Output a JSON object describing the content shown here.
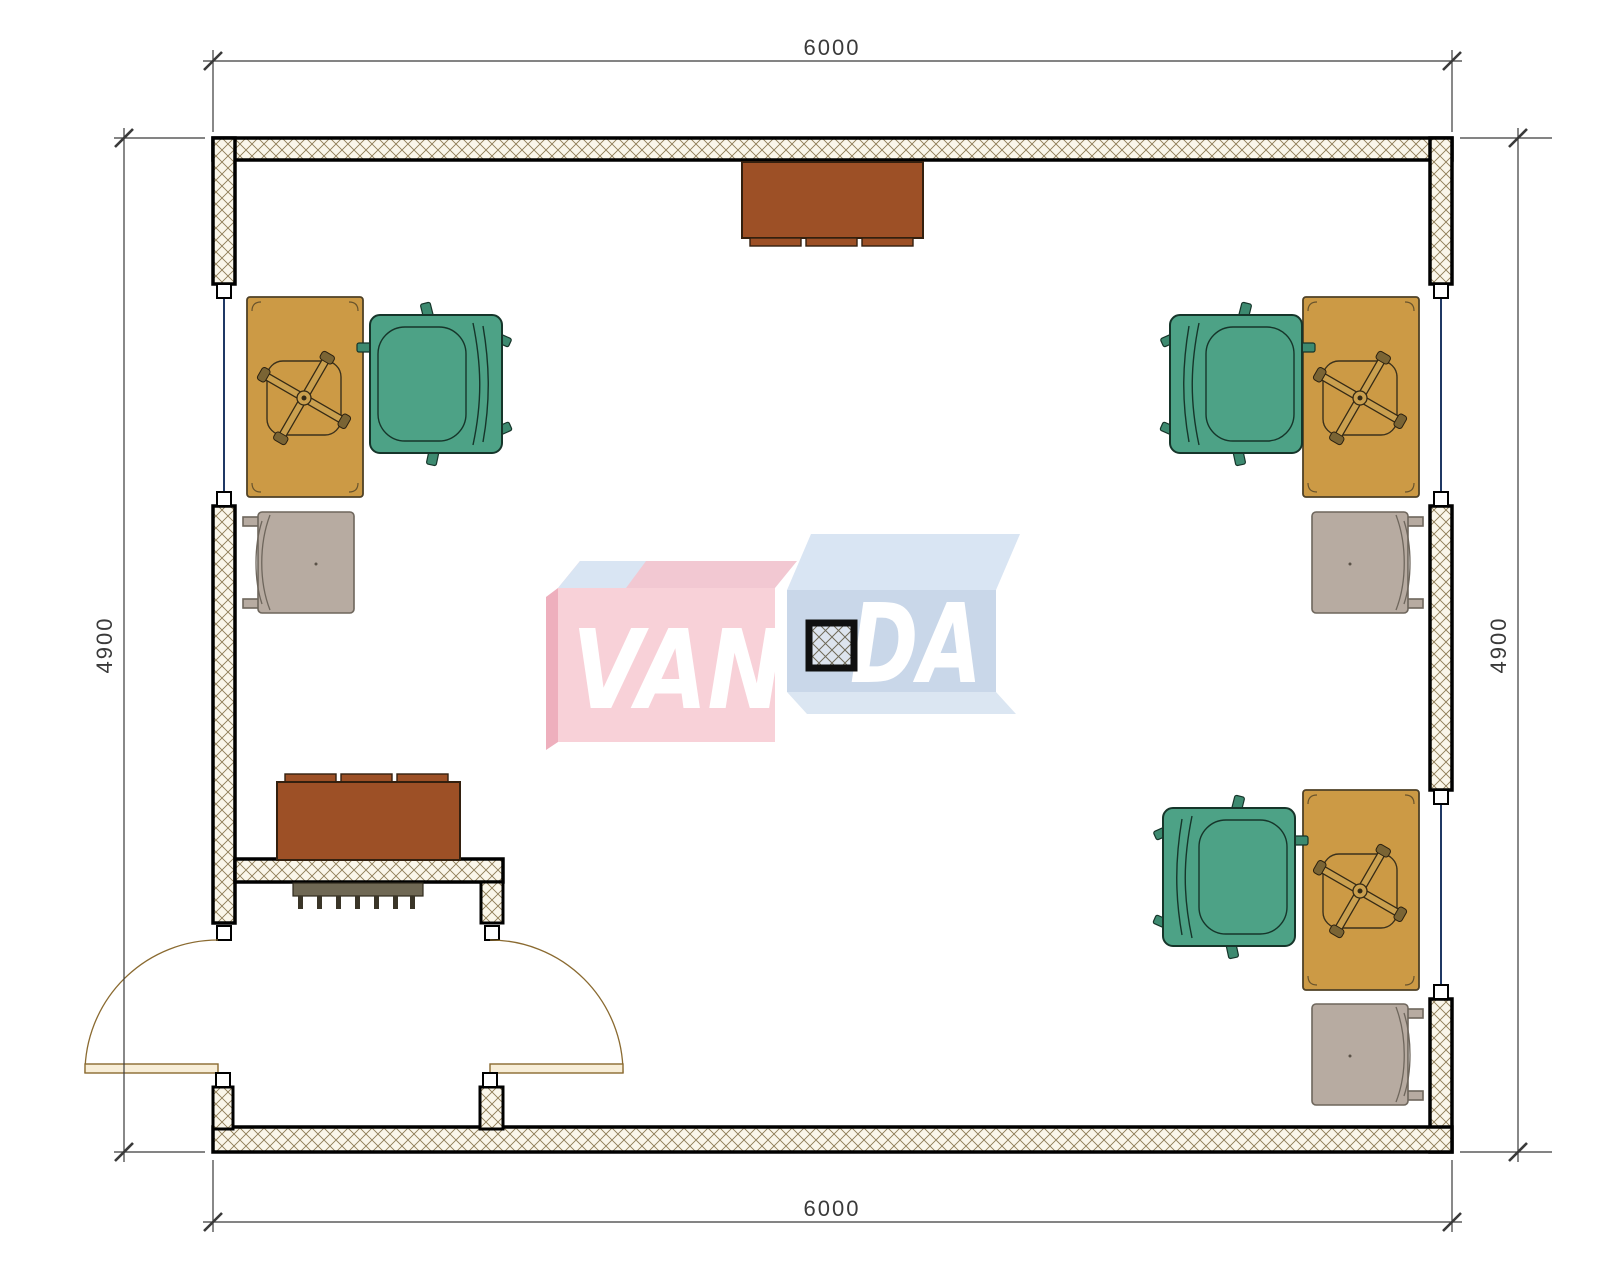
{
  "page": {
    "title": "Office room floor plan"
  },
  "dimensions": {
    "top": "6000",
    "bottom": "6000",
    "left": "4900",
    "right": "4900"
  },
  "logo": {
    "brand": "VANDA",
    "left_text": "VAN",
    "right_text": "DA"
  },
  "objects": [
    "desk",
    "desk-chair-base",
    "office-armchair",
    "side-chair",
    "cabinet",
    "radiator",
    "structural-column",
    "window",
    "double-entry-door"
  ],
  "colors": {
    "wall-border": "#000000",
    "hatch-bg": "#faf6ea",
    "hatch-line": "#8d7b55",
    "glass": "#1f3864",
    "cap": "#ffffff",
    "dim": "#3a3a3a",
    "desk": "#cc9a45",
    "desk-stroke": "#4f4126",
    "chair-green": "#4da286",
    "chair-green-dark": "#16352a",
    "chair-gray": "#b7aba1",
    "chair-gray-stroke": "#6e665c",
    "cabinet": "#9d5026",
    "cabinet-stroke": "#33200f",
    "radiator": "#6f6854",
    "door": "#8a6a30",
    "door-leaf": "#f8eed8",
    "logo-pink": "#f8d1d8",
    "logo-pink-top": "#f2c8d2",
    "logo-pink-side": "#eeafbd",
    "logo-blue": "#c9d7e9",
    "logo-blue-top": "#d9e5f3",
    "logo-blue-bottom": "#dbe6f2",
    "logo-letter": "#ffffff"
  }
}
